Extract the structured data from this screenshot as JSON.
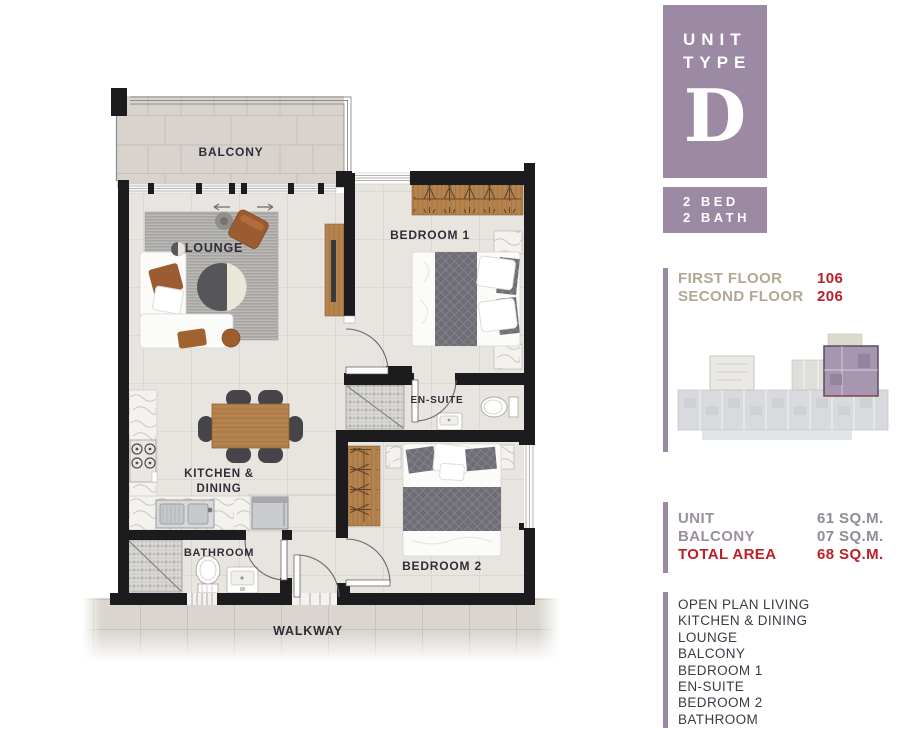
{
  "badge": {
    "unit_word": "UNIT",
    "type_word": "TYPE",
    "letter": "D"
  },
  "bed_bath": {
    "line1": "2 BED",
    "line2": "2 BATH"
  },
  "floors": {
    "first_label": "FIRST FLOOR",
    "first_number": "106",
    "second_label": "SECOND FLOOR",
    "second_number": "206"
  },
  "areas": {
    "unit_label": "UNIT",
    "unit_value": "61 SQ.M.",
    "balcony_label": "BALCONY",
    "balcony_value": "07 SQ.M.",
    "total_label": "TOTAL AREA",
    "total_value": "68 SQ.M."
  },
  "features": {
    "items": [
      "OPEN PLAN LIVING",
      "KITCHEN & DINING",
      "LOUNGE",
      "BALCONY",
      "BEDROOM 1",
      "EN-SUITE",
      "BEDROOM 2",
      "BATHROOM"
    ]
  },
  "plan_labels": {
    "balcony": "BALCONY",
    "lounge": "LOUNGE",
    "bedroom1": "BEDROOM 1",
    "ensuite": "EN-SUITE",
    "kitchen_line1": "KITCHEN &",
    "kitchen_line2": "DINING",
    "bathroom": "BATHROOM",
    "bedroom2": "BEDROOM 2",
    "walkway": "WALKWAY"
  },
  "colors": {
    "accent_purple": "#9c89a3",
    "accent_red": "#bb2028",
    "taupe": "#b2a794",
    "mauve": "#9a8fa0",
    "value_gray": "#8d8d95",
    "feature_text": "#3b3b45",
    "wall_black": "#1c1c1e"
  }
}
